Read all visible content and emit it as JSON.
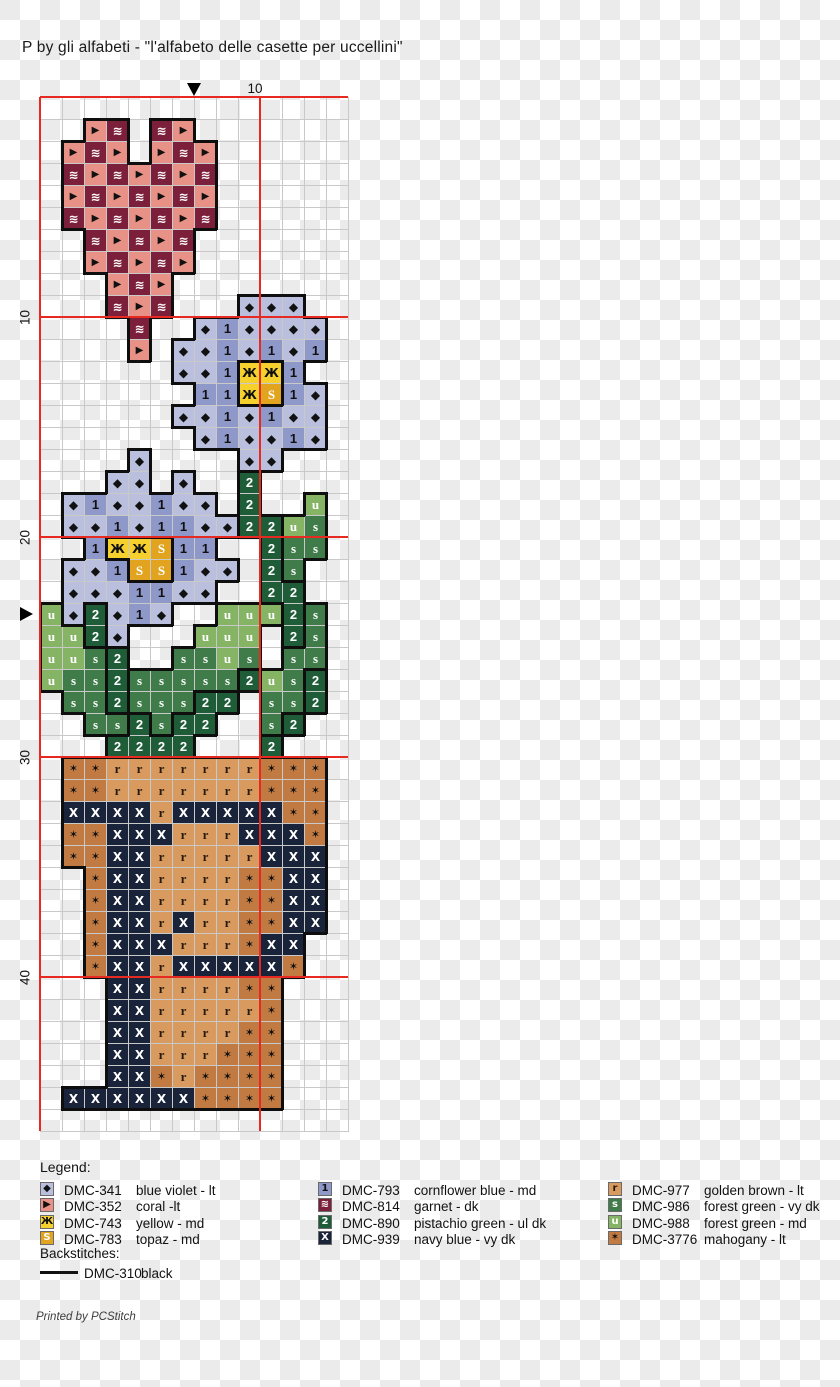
{
  "title": "P by gli alfabeti - \"l'alfabeto delle casette per uccellini\"",
  "footer": "Printed by PCStitch",
  "colors": {
    "checker_light": "#ffffff",
    "checker_dark": "#ebebeb",
    "grid_line": "#c9c9c9",
    "major_line_red": "#e62a21",
    "backstitch_black": "#0e0e0e"
  },
  "grid": {
    "cols": 14,
    "rows": 47,
    "cell_px": 22,
    "top_label": "10",
    "side_labels": [
      {
        "text": "10",
        "row": 10
      },
      {
        "text": "20",
        "row": 20
      },
      {
        "text": "30",
        "row": 30
      },
      {
        "text": "40",
        "row": 40
      }
    ]
  },
  "palette": {
    "v": {
      "glyph": "◆",
      "bg": "#b9bfdc",
      "fg": "#111111",
      "dmc": "DMC-341",
      "name": "blue violet - lt",
      "group": "petal"
    },
    "c": {
      "glyph": "▶",
      "bg": "#e89186",
      "fg": "#111111",
      "dmc": "DMC-352",
      "name": "coral -lt",
      "group": "heart"
    },
    "y": {
      "glyph": "Ж",
      "bg": "#f6d02c",
      "fg": "#111111",
      "dmc": "DMC-743",
      "name": "yellow - md",
      "group": "center"
    },
    "t": {
      "glyph": "S",
      "bg": "#e2a41f",
      "fg": "#ffffff",
      "dmc": "DMC-783",
      "name": "topaz - md",
      "group": "center"
    },
    "b": {
      "glyph": "1",
      "bg": "#8e98c9",
      "fg": "#111111",
      "dmc": "DMC-793",
      "name": "cornflower blue - md",
      "group": "petal"
    },
    "g": {
      "glyph": "≋",
      "bg": "#7c1f3b",
      "fg": "#ffffff",
      "dmc": "DMC-814",
      "name": "garnet - dk",
      "group": "heart"
    },
    "p": {
      "glyph": "2",
      "bg": "#1f5c38",
      "fg": "#ffffff",
      "dmc": "DMC-890",
      "name": "pistachio green - ul dk",
      "group": "pistachio"
    },
    "n": {
      "glyph": "X",
      "bg": "#192339",
      "fg": "#ffffff",
      "dmc": "DMC-939",
      "name": "navy blue - vy dk",
      "group": "pot"
    },
    "r": {
      "glyph": "r",
      "bg": "#d89a5e",
      "fg": "#26190e",
      "dmc": "DMC-977",
      "name": "golden brown - lt",
      "group": "pot"
    },
    "f": {
      "glyph": "s",
      "bg": "#3f7c4a",
      "fg": "#ffffff",
      "dmc": "DMC-986",
      "name": "forest green - vy dk",
      "group": "forest"
    },
    "u": {
      "glyph": "u",
      "bg": "#85b464",
      "fg": "#ffffff",
      "dmc": "DMC-988",
      "name": "forest green - md",
      "group": "forest"
    },
    "m": {
      "glyph": "✶",
      "bg": "#c17a42",
      "fg": "#111111",
      "dmc": "DMC-3776",
      "name": "mahogany - lt",
      "group": "pot"
    }
  },
  "pattern": [
    "..............",
    "..cg.gc.......",
    ".cgc.cgc......",
    ".gcgcgcg......",
    ".cgcgcgc......",
    ".gcgcgcg......",
    "..gcgcg.......",
    "..cgcgc.......",
    "...cgc........",
    "...gcg...vvv..",
    "....g..vbvvvv.",
    "....c.vvbvbvb.",
    "......vvbyyb..",
    ".......bbytbv.",
    "......vvbvbvv.",
    ".......vbvvbv.",
    "....v....vv...",
    "...vv.v..p....",
    ".vbvvbvv.p..u.",
    ".vvbvbbvvppuf.",
    "..byytbb..pff.",
    ".vvbttbvv.pf..",
    ".vvvbbvv..pp..",
    "uvpvbv..uuupf.",
    "uupv...uuu.pf.",
    "uufp..ffuf.ff.",
    "uffpfffffpufp.",
    ".ffpfffpp.ffp.",
    "..ffpfpp..fp..",
    "...pppp...p...",
    ".mmrrrrrrrmmm.",
    ".mmrrrrrrrmmm.",
    ".nnnnrnnnnnmm.",
    ".mmnnnrrrnnnm.",
    ".mmnnrrrrrnnn.",
    "..mnnrrrrmmnn.",
    "..mnnrrrrmmnn.",
    "..mnnrnrrmmnn.",
    "..mnnnrrrmnn..",
    "..mnnrnnnnnm..",
    "...nnrrrrmm...",
    "...nnrrrrrm...",
    "...nnrrrrmm...",
    "...nnrrrmmm...",
    "...nnmrmmmm...",
    ".nnnnnnmmmm...",
    ".............."
  ],
  "legend": {
    "title": "Legend:",
    "columns": [
      {
        "x": 40,
        "keys": [
          "v",
          "c",
          "y",
          "t"
        ]
      },
      {
        "x": 318,
        "keys": [
          "b",
          "g",
          "p",
          "n"
        ]
      },
      {
        "x": 608,
        "keys": [
          "r",
          "f",
          "u",
          "m"
        ]
      }
    ],
    "backstitches_label": "Backstitches:",
    "backstitch": {
      "code": "DMC-310",
      "name": "black",
      "color": "#111111"
    }
  }
}
